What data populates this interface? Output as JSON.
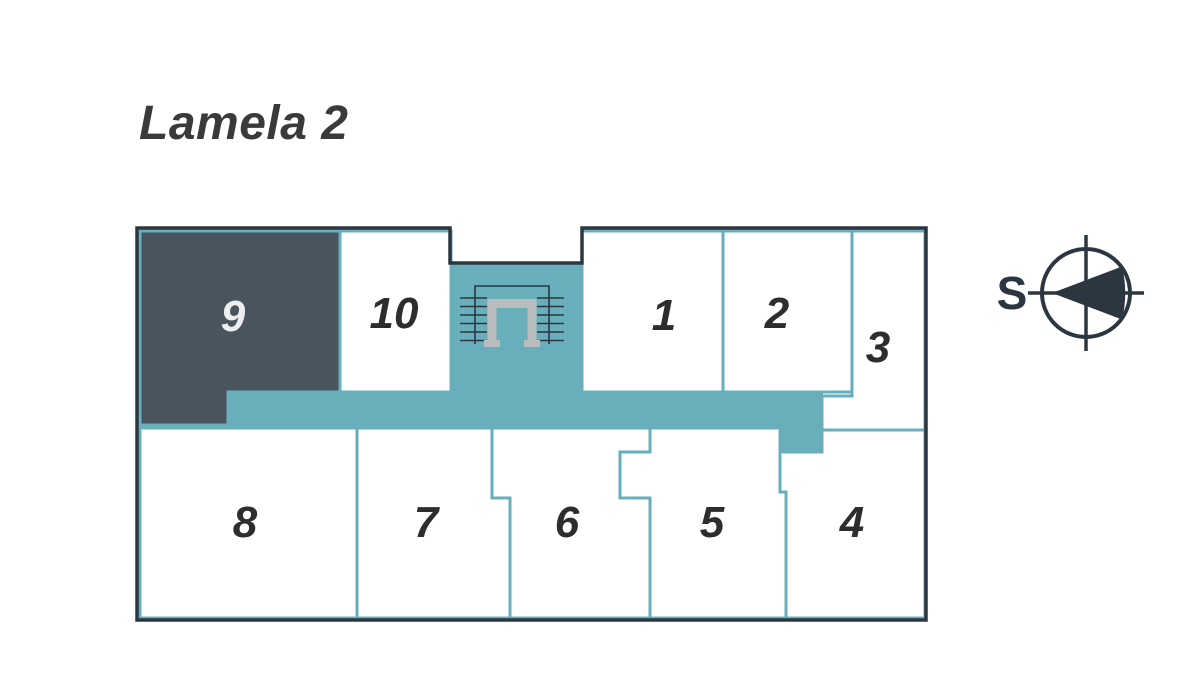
{
  "page": {
    "title": "Lamela 2"
  },
  "compass": {
    "south_label": "S"
  },
  "floorplan": {
    "units": [
      {
        "label": "1",
        "highlighted": false
      },
      {
        "label": "2",
        "highlighted": false
      },
      {
        "label": "3",
        "highlighted": false
      },
      {
        "label": "4",
        "highlighted": false
      },
      {
        "label": "5",
        "highlighted": false
      },
      {
        "label": "6",
        "highlighted": false
      },
      {
        "label": "7",
        "highlighted": false
      },
      {
        "label": "8",
        "highlighted": false
      },
      {
        "label": "9",
        "highlighted": true
      },
      {
        "label": "10",
        "highlighted": false
      }
    ]
  },
  "colors": {
    "teal": "#69AEBB",
    "dark": "#4A545E",
    "outline": "#2B3640",
    "ink": "#2D2D2D",
    "light": "#ECEEF0",
    "rail": "#B8BCBD",
    "title": "#3A3A3A",
    "bg": "#FFFFFF"
  }
}
